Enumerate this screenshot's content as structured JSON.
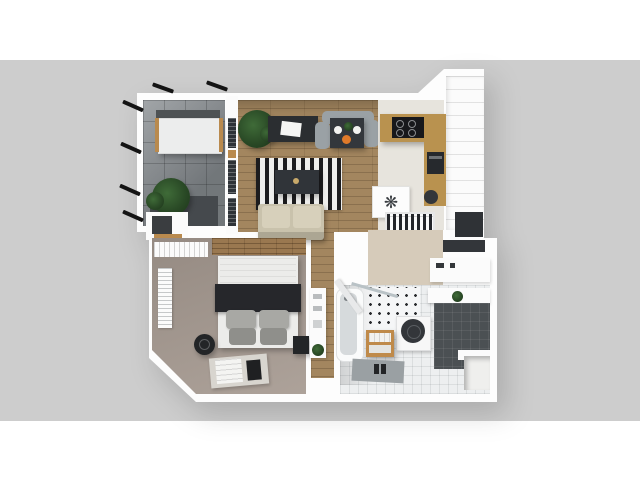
{
  "scene": {
    "title": "3D rendered top-down floor plan of a one-bedroom apartment",
    "view": "isometric top-down architectural render",
    "background": "#cdcdcd",
    "letterbox": "#ffffff"
  },
  "colors": {
    "backdrop": "#cdcdcd",
    "wall": "#fbfbfb",
    "balcony_tile": "#82878b",
    "balcony_dark": "#45494d",
    "wood_floor": "#a3865f",
    "kitchen_floor": "#e7e4dd",
    "hall_floor": "#d6cbba",
    "carpet": "#a69a91",
    "tile_floor": "#edeff0",
    "headboard_wood": "#9a7850",
    "rug_black": "#1c1c1e",
    "rug_white": "#eeeeec",
    "coffee_table": "#303439",
    "sofa": "#c9c2ac",
    "sofa_cushion": "#d7d0bb",
    "tv_console": "#2b2e31",
    "dining_table": "#33373c",
    "dining_chair": "#9aa1a5",
    "counter_wood": "#b9924f",
    "cooktop": "#17181b",
    "oven": "#26292d",
    "appliance_dark": "#33363a",
    "blanket": "#26272b",
    "bed_linen": "#ececea",
    "pillow": "#a8a8a4",
    "pillow_dark": "#8f8f8b",
    "speaker": "#232527",
    "vanity": "#4b5053",
    "stool_wood": "#bf8a4a",
    "bath_mat": "#9aa0a3",
    "tub_inner": "#d6dadc",
    "plant_green": "#2a4a26",
    "accent_orange": "#e07a2a",
    "niche_dark": "#2f3236",
    "daybed_canopy": "#4e5254",
    "railing": "#141414"
  },
  "icons": {
    "fan": "❋"
  },
  "rooms": [
    {
      "name": "balcony",
      "furniture": [
        "daybed",
        "potted-plant",
        "railing-posts",
        "tile-floor"
      ]
    },
    {
      "name": "living-room",
      "furniture": [
        "sofa",
        "striped-rug",
        "coffee-table",
        "tv-console",
        "dining-table",
        "dining-chairs",
        "plates",
        "plant"
      ]
    },
    {
      "name": "kitchen",
      "furniture": [
        "wood-counter",
        "cooktop",
        "oven",
        "sink",
        "fridge-fan-unit",
        "wine-rack",
        "tall-cabinets"
      ]
    },
    {
      "name": "hallway",
      "furniture": [
        "entry-closet",
        "wall-niche",
        "console-shelf"
      ]
    },
    {
      "name": "bedroom",
      "furniture": [
        "double-bed",
        "blanket",
        "pillows",
        "speakers",
        "radiator",
        "floor-rug",
        "magazines",
        "toiletry-shelf",
        "wood-accent-wall"
      ]
    },
    {
      "name": "bathroom",
      "furniture": [
        "bathtub",
        "shower-glass",
        "dotted-tile-wall",
        "washing-machine",
        "towel-stool",
        "bath-mat",
        "vanity-counter",
        "wall-niche"
      ]
    }
  ]
}
